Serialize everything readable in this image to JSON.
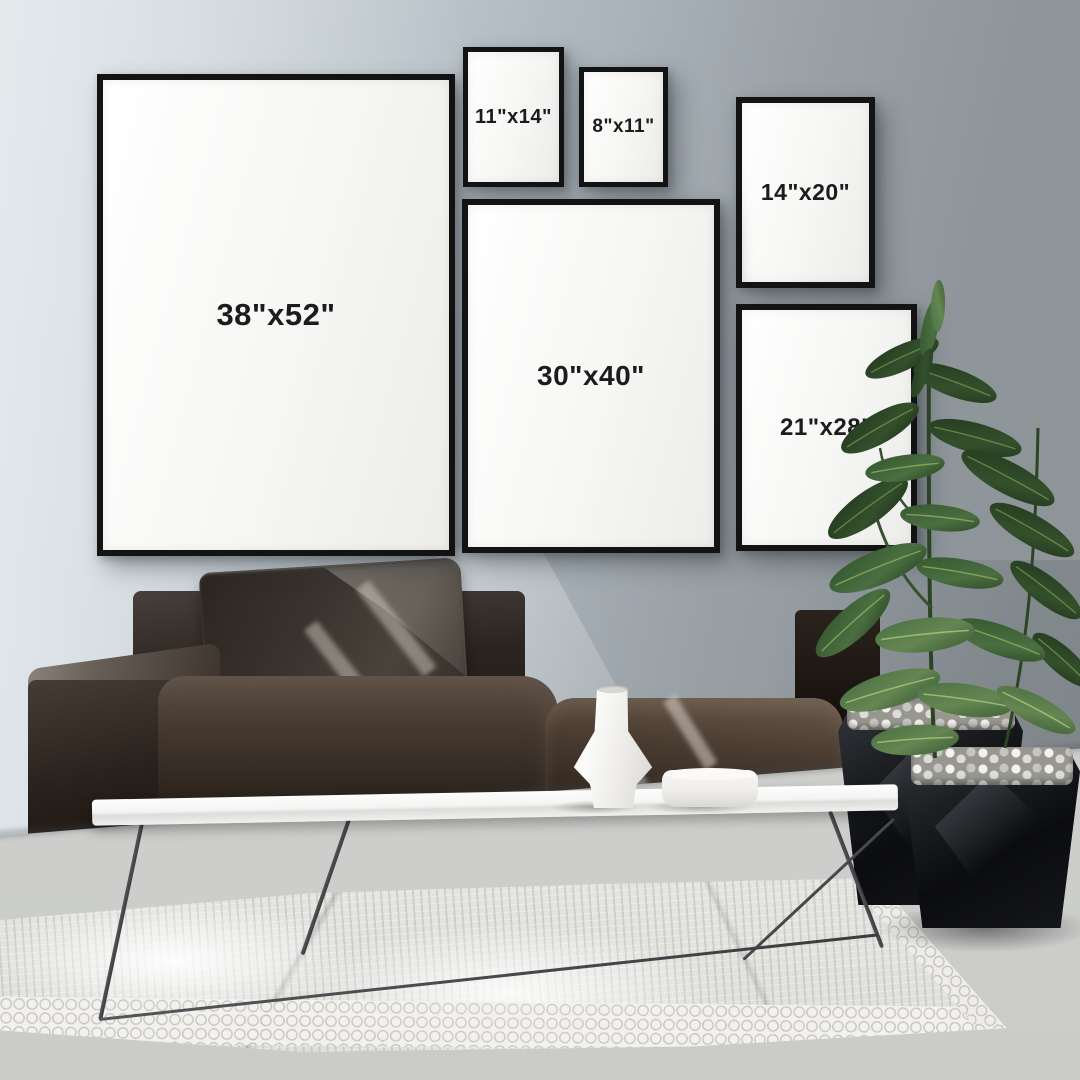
{
  "scene_title": "Gallery wall frame size mockup in modern living room",
  "frames": [
    {
      "id": "38x52",
      "label": "38\"x52\""
    },
    {
      "id": "11x14",
      "label": "11\"x14\""
    },
    {
      "id": "8x11",
      "label": "8\"x11\""
    },
    {
      "id": "14x20",
      "label": "14\"x20\""
    },
    {
      "id": "30x40",
      "label": "30\"x40\""
    },
    {
      "id": "21x28",
      "label": "21\"x28\""
    }
  ],
  "objects": {
    "wall": "blue-gray painted wall",
    "floor": "light concrete floor",
    "rug": "white chunky-knit rug",
    "sofa": "dark brown suede modular sofa with pillow",
    "coffee_table": "white slab coffee table with wire legs",
    "vase": "white geometric vase",
    "bowl": "white round dish",
    "planters": "two black faceted planters with white pebbles",
    "plant": "rubber plant with large green leaves"
  },
  "colors": {
    "wall_left": "#d9e0e4",
    "wall_right": "#8d9396",
    "floor": "#cbccca",
    "frame_border": "#131313",
    "frame_canvas": "#f6f6f4",
    "label_text": "#1c1c1c",
    "sofa_dark": "#17110d",
    "sofa_highlight": "#6b5a4d",
    "rug": "#e8e8e5",
    "table": "#fafafa",
    "planter": "#141518",
    "leaf_dark": "#2e4729",
    "leaf_light": "#648653"
  }
}
